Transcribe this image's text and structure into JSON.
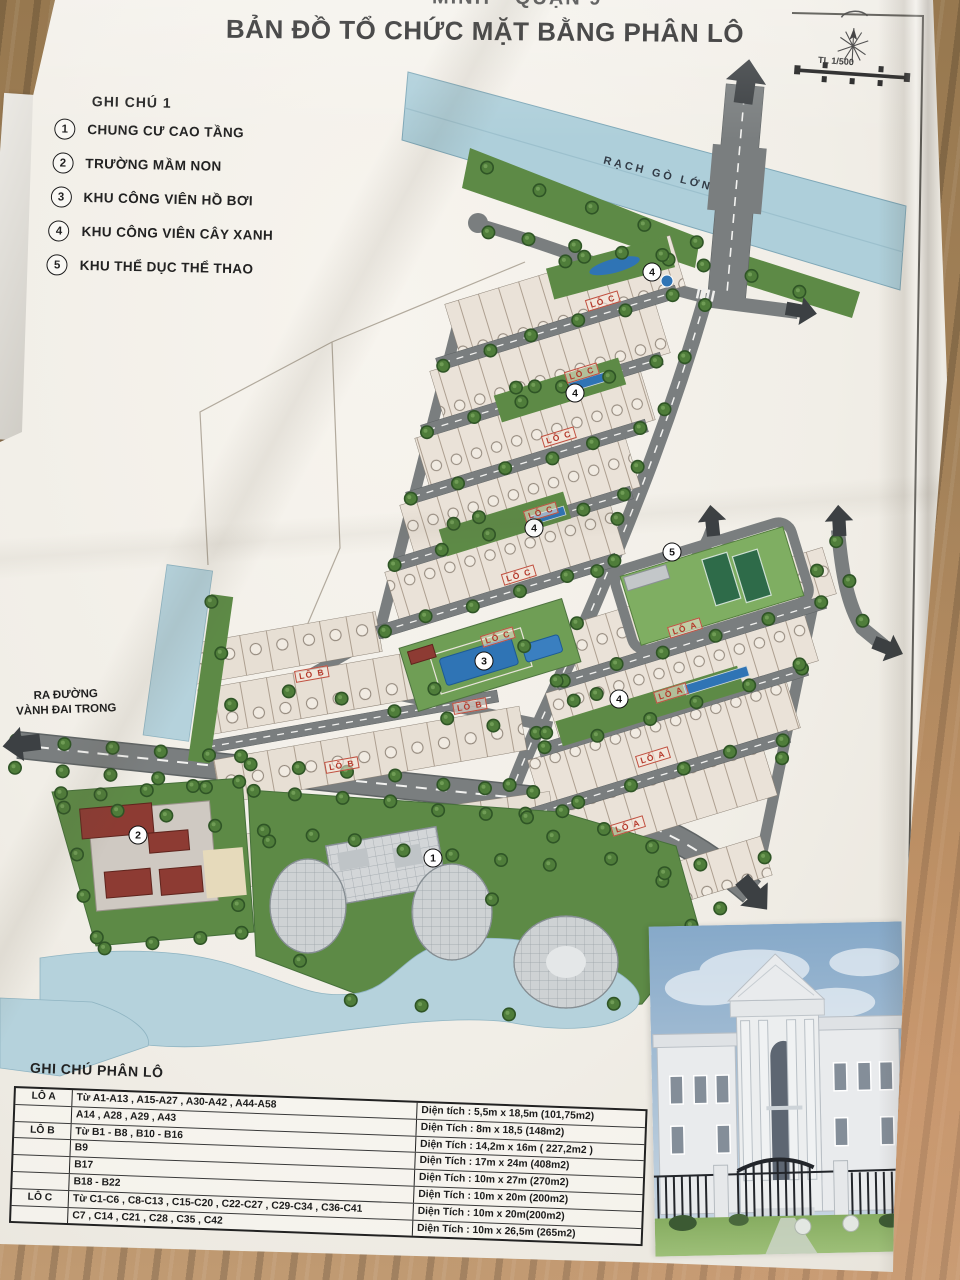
{
  "header": {
    "top_line_fragment": "MINH - QUẬN 9",
    "title": "BẢN ĐỒ TỔ CHỨC MẶT BẰNG PHÂN LÔ",
    "scale_label": "TL 1/500"
  },
  "legend": {
    "heading": "GHI CHÚ 1",
    "items": [
      {
        "num": "1",
        "label": "CHUNG CƯ CAO TẦNG"
      },
      {
        "num": "2",
        "label": "TRƯỜNG MẦM NON"
      },
      {
        "num": "3",
        "label": "KHU CÔNG VIÊN HỒ BƠI"
      },
      {
        "num": "4",
        "label": "KHU CÔNG VIÊN CÂY XANH"
      },
      {
        "num": "5",
        "label": "KHU THỂ DỤC THỂ THAO"
      }
    ]
  },
  "map": {
    "river_label": "RẠCH GÒ LỚN",
    "west_exit_line1": "RA ĐƯỜNG",
    "west_exit_line2": "VÀNH ĐAI TRONG",
    "markers": [
      {
        "num": "4",
        "x": 652,
        "y": 272
      },
      {
        "num": "4",
        "x": 575,
        "y": 393
      },
      {
        "num": "4",
        "x": 534,
        "y": 528
      },
      {
        "num": "3",
        "x": 484,
        "y": 661
      },
      {
        "num": "5",
        "x": 672,
        "y": 552
      },
      {
        "num": "4",
        "x": 619,
        "y": 699
      },
      {
        "num": "2",
        "x": 138,
        "y": 835
      },
      {
        "num": "1",
        "x": 433,
        "y": 858
      }
    ],
    "zone_labels": [
      {
        "text": "LÔ C",
        "x": 603,
        "y": 301,
        "rot": -17
      },
      {
        "text": "LÔ C",
        "x": 582,
        "y": 373,
        "rot": -17
      },
      {
        "text": "LÔ C",
        "x": 559,
        "y": 437,
        "rot": -17
      },
      {
        "text": "LÔ C",
        "x": 541,
        "y": 512,
        "rot": -17
      },
      {
        "text": "LÔ C",
        "x": 519,
        "y": 575,
        "rot": -17
      },
      {
        "text": "LÔ C",
        "x": 498,
        "y": 637,
        "rot": -17
      },
      {
        "text": "LÔ A",
        "x": 685,
        "y": 628,
        "rot": -17
      },
      {
        "text": "LÔ A",
        "x": 671,
        "y": 693,
        "rot": -17
      },
      {
        "text": "LÔ A",
        "x": 653,
        "y": 757,
        "rot": -17
      },
      {
        "text": "LÔ A",
        "x": 628,
        "y": 826,
        "rot": -17
      },
      {
        "text": "LÔ B",
        "x": 312,
        "y": 674,
        "rot": -10
      },
      {
        "text": "LÔ B",
        "x": 470,
        "y": 706,
        "rot": -10
      },
      {
        "text": "LÔ B",
        "x": 342,
        "y": 765,
        "rot": -10
      }
    ]
  },
  "parcel_table": {
    "heading": "GHI CHÚ PHÂN LÔ",
    "rows": [
      {
        "group": "LÔ A",
        "lots": "Từ A1-A13 , A15-A27 , A30-A42 , A44-A58",
        "area": "Diện tích : 5,5m x 18,5m (101,75m2)"
      },
      {
        "group": "",
        "lots": "A14 , A28 , A29 , A43",
        "area": "Diện Tích : 8m x 18,5 (148m2)"
      },
      {
        "group": "LÔ B",
        "lots": "Từ B1 - B8 , B10 - B16",
        "area": "Diện Tích : 14,2m x 16m ( 227,2m2 )"
      },
      {
        "group": "",
        "lots": "B9",
        "area": "Diện Tích : 17m x 24m (408m2)"
      },
      {
        "group": "",
        "lots": "B17",
        "area": "Diện Tích : 10m x 27m (270m2)"
      },
      {
        "group": "",
        "lots": "B18 - B22",
        "area": "Diện Tích : 10m x 20m (200m2)"
      },
      {
        "group": "LÔ C",
        "lots": "Từ C1-C6 , C8-C13 , C15-C20 , C22-C27 , C29-C34 , C36-C41",
        "area": "Diện Tích : 10m x 20m(200m2)"
      },
      {
        "group": "",
        "lots": "C7 , C14 , C21 , C28 , C35 , C42",
        "area": "Diện Tích : 10m x 26,5m (265m2)"
      }
    ]
  },
  "colors": {
    "zone_label_red": "#b5382a",
    "water": "#aecfda",
    "pool_blue": "#2f74b5",
    "grass": "#5d8a46",
    "road_gray": "#7a7e7f",
    "lot_beige": "#eae2d8"
  }
}
